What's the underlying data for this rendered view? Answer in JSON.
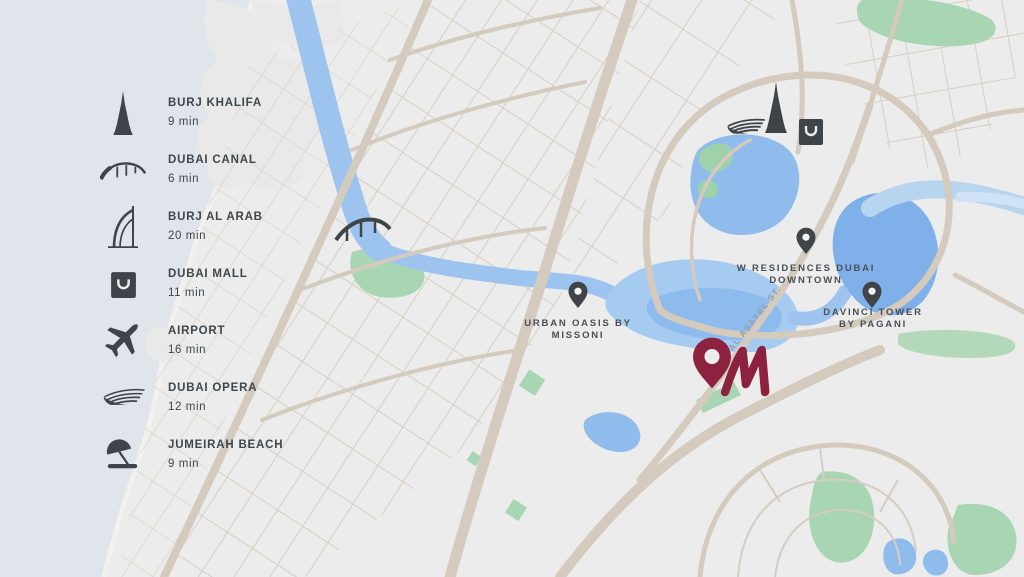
{
  "legend": {
    "items": [
      {
        "id": "burj-khalifa",
        "label": "BURJ KHALIFA",
        "time": "9 min",
        "icon": "burj-khalifa-icon"
      },
      {
        "id": "dubai-canal",
        "label": "DUBAI CANAL",
        "time": "6 min",
        "icon": "bridge-icon"
      },
      {
        "id": "burj-al-arab",
        "label": "BURJ AL ARAB",
        "time": "20 min",
        "icon": "sail-hotel-icon"
      },
      {
        "id": "dubai-mall",
        "label": "DUBAI MALL",
        "time": "11 min",
        "icon": "shopping-bag-icon"
      },
      {
        "id": "airport",
        "label": "AIRPORT",
        "time": "16 min",
        "icon": "airplane-icon"
      },
      {
        "id": "dubai-opera",
        "label": "DUBAI OPERA",
        "time": "12 min",
        "icon": "opera-icon"
      },
      {
        "id": "jumeirah-beach",
        "label": "JUMEIRAH BEACH",
        "time": "9 min",
        "icon": "beach-umbrella-icon"
      }
    ]
  },
  "markers": [
    {
      "id": "urban-oasis",
      "line1": "URBAN OASIS BY",
      "line2": "MISSONI"
    },
    {
      "id": "w-residences",
      "line1": "W RESIDENCES DUBAI",
      "line2": "DOWNTOWN"
    },
    {
      "id": "davinci-tower",
      "line1": "DAVINCI TOWER",
      "line2": "BY PAGANI"
    }
  ],
  "street": {
    "label": "AL ASAYEL ST."
  },
  "colors": {
    "accent": "#8d2140",
    "land": "#ebeceb",
    "sea": "#dfe5ea",
    "road": "#d4cabd",
    "road_minor": "#d8cfc3",
    "park": "#a9d6b2",
    "water_deep": "#7fb0e9",
    "water": "#9cc4ee",
    "water_light": "#b8d5f0",
    "icon_dark": "#3e4449",
    "marker_text": "#4a5056",
    "street_text": "#989da1"
  }
}
